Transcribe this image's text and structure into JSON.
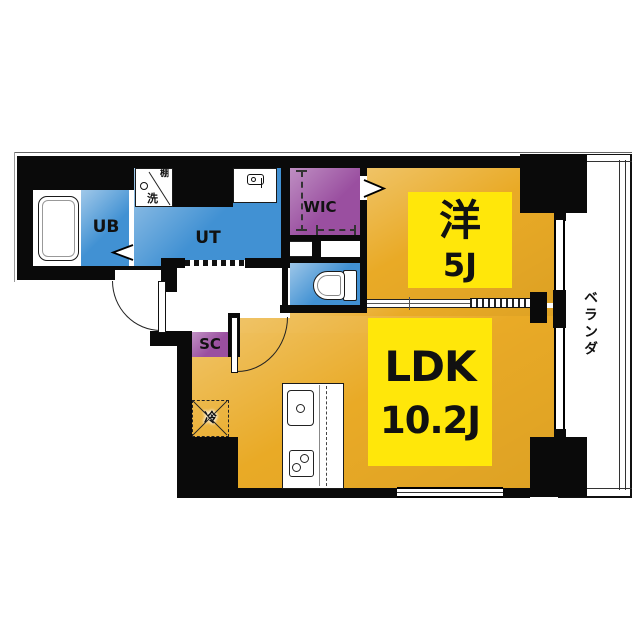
{
  "floorplan": {
    "rooms": {
      "unit_bath": {
        "label": "UB"
      },
      "utility": {
        "label": "UT"
      },
      "walk_in_closet": {
        "label": "WIC"
      },
      "shoe_closet": {
        "label": "SC"
      },
      "western_room": {
        "name": "洋",
        "size": "5J"
      },
      "ldk": {
        "name": "LDK",
        "size": "10.2J"
      },
      "veranda": {
        "label": "ベランダ"
      }
    },
    "annotations": {
      "refrigerator": "冷",
      "laundry_shelf": "棚",
      "laundry_washer": "洗"
    },
    "colors": {
      "wall_black": "#0a0a0a",
      "wet_area_blue": "#4191d3",
      "closet_purple": "#9a4fa0",
      "room_orange": "#e9aa26",
      "label_yellow": "#ffe70a",
      "floor_white": "#ffffff"
    }
  }
}
